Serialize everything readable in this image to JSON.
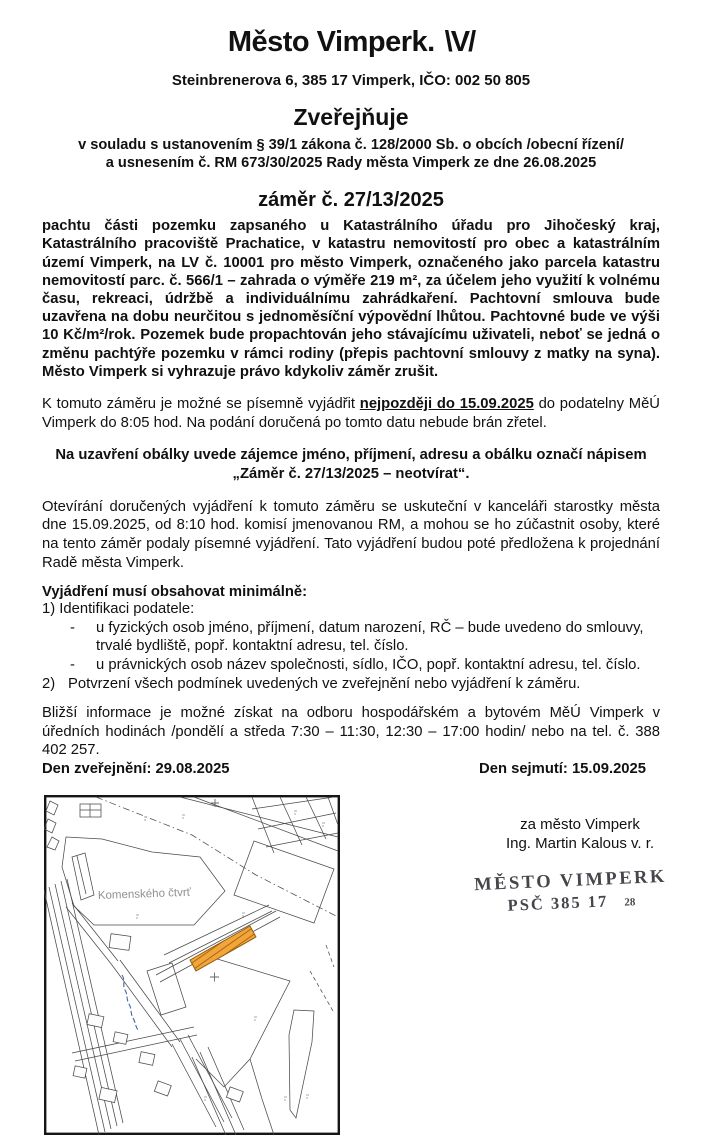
{
  "header": {
    "city_title": "Město Vimperk.",
    "logo_mark": "\\V/",
    "address": "Steinbrenerova 6, 385 17 Vimperk, IČO: 002 50 805",
    "publishes": "Zveřejňuje",
    "legal_line1": "v souladu s ustanovením § 39/1 zákona č. 128/2000 Sb. o obcích /obecní řízení/",
    "legal_line2": "a usnesením č. RM 673/30/2025 Rady města Vimperk ze dne 26.08.2025",
    "intent_number": "záměr č. 27/13/2025"
  },
  "intent": {
    "description": "pachtu části pozemku zapsaného u Katastrálního úřadu pro Jihočeský kraj, Katastrálního pracoviště Prachatice, v katastru nemovitostí pro obec a katastrálním území Vimperk, na LV č. 10001 pro město Vimperk, označeného jako parcela katastru nemovitostí parc. č. 566/1 – zahrada o výměře 219 m², za účelem jeho využití k volnému času, rekreaci, údržbě a individuálnímu zahrádkaření. Pachtovní smlouva bude uzavřena na dobu neurčitou s jednoměsíční výpovědní lhůtou. Pachtovné bude ve výši 10 Kč/m²/rok. Pozemek bude propachtován jeho stávajícímu uživateli, neboť se jedná o změnu pachtýře pozemku v rámci rodiny (přepis pachtovní smlouvy z matky na syna). Město Vimperk si vyhrazuje právo kdykoliv záměr zrušit."
  },
  "response": {
    "prefix": "K tomuto záměru je možné se písemně vyjádřit",
    "deadline": "nejpozději do 15.09.2025",
    "suffix": "do podatelny MěÚ Vimperk do 8:05 hod. Na podání doručená po tomto datu nebude brán zřetel."
  },
  "envelope": {
    "line1": "Na uzavření obálky uvede zájemce jméno, příjmení, adresu a obálku označí nápisem",
    "line2": "„Záměr č. 27/13/2025 – neotvírat“."
  },
  "opening": {
    "paragraph": "Otevírání doručených vyjádření k tomuto záměru se uskuteční v kanceláři starostky města dne 15.09.2025, od 8:10 hod. komisí jmenovanou RM, a mohou se ho zúčastnit osoby, které na tento záměr podaly písemné vyjádření. Tato vyjádření budou poté předložena k projednání Radě města Vimperk."
  },
  "requirements": {
    "heading": "Vyjádření musí obsahovat minimálně:",
    "item1": "1) Identifikaci podatele:",
    "sub1_marker": "-",
    "sub1": "u fyzických osob jméno, příjmení, datum narození, RČ – bude uvedeno do smlouvy, trvalé bydliště, popř. kontaktní adresu, tel. číslo.",
    "sub2_marker": "-",
    "sub2": "u právnických osob název společnosti, sídlo, IČO, popř. kontaktní adresu, tel. číslo.",
    "item2_marker": "2)",
    "item2": "Potvrzení všech podmínek uvedených ve zveřejnění nebo vyjádření k záměru."
  },
  "info": {
    "paragraph": "Bližší informace je možné získat na odboru hospodářském a bytovém MěÚ Vimperk v úředních hodinách /pondělí a středa 7:30 – 11:30, 12:30 – 17:00 hodin/ nebo na tel. č. 388 402 257."
  },
  "dates": {
    "published": "Den zveřejnění: 29.08.2025",
    "removed": "Den sejmutí: 15.09.2025"
  },
  "map": {
    "district_label": "Komenského čtvrť",
    "highlight_color": "#f2a53a"
  },
  "signature": {
    "line1": "za město Vimperk",
    "line2": "Ing. Martin Kalous v. r."
  },
  "stamp": {
    "line1": "MĚSTO VIMPERK",
    "line2": "PSČ 385 17",
    "number": "28"
  }
}
